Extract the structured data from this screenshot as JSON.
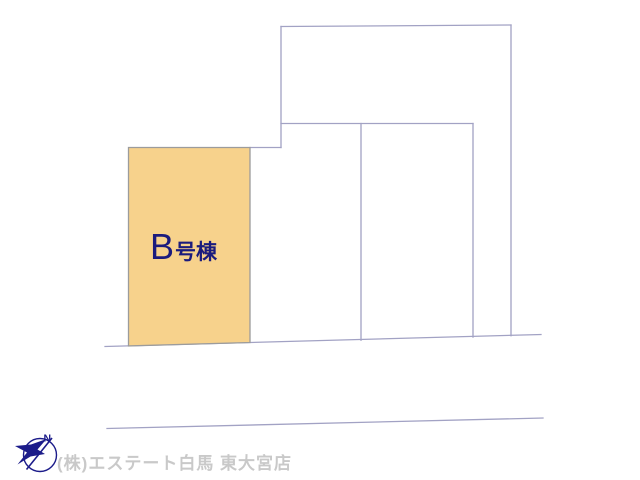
{
  "site_plan": {
    "highlighted_parcel": {
      "label_prefix": "B",
      "label_suffix": "号棟",
      "fill": "#f7d28c",
      "border": "#9c9c9c",
      "label_color": "#1b1b7d"
    },
    "boundary_line_color": "#a2a2c4"
  },
  "footer": {
    "compass": {
      "label": "N",
      "color": "#1c1c8a"
    },
    "company": {
      "text": "(株)エステート白馬 東大宮店",
      "color": "#c9c9c9"
    }
  }
}
